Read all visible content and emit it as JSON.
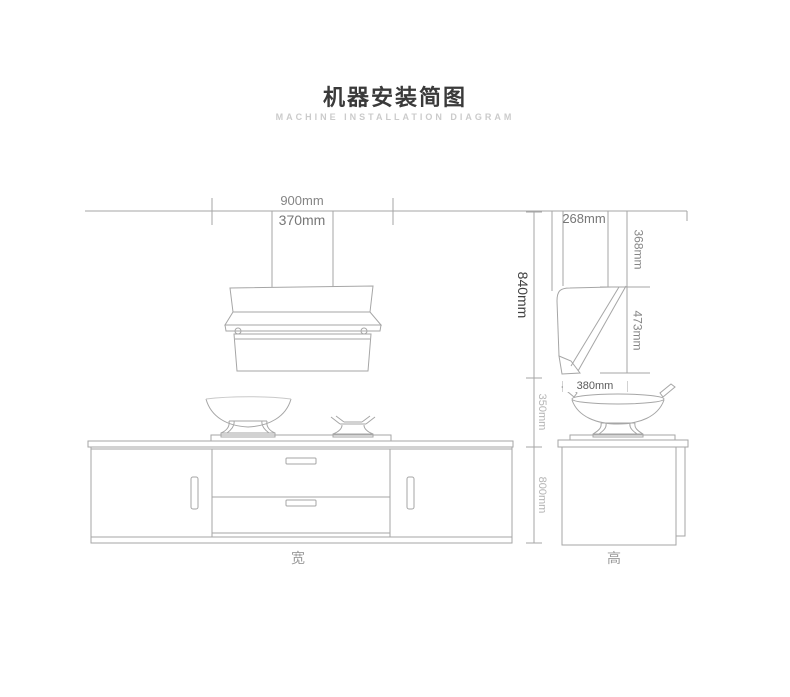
{
  "header": {
    "title": "机器安装简图",
    "subtitle": "MACHINE INSTALLATION DIAGRAM"
  },
  "front_view": {
    "dim_total_width": "900mm",
    "dim_duct_width": "370mm",
    "dim_ceiling_to_hood_bottom": "840mm",
    "dim_hood_to_countertop": "350mm",
    "dim_countertop_height": "800mm",
    "axis_label": "宽"
  },
  "side_view": {
    "dim_top_depth": "268mm",
    "dim_upper_section_height": "368mm",
    "dim_body_height": "473mm",
    "dim_bottom_depth": "380mm",
    "axis_label": "高"
  },
  "colors": {
    "line": "#a6a6a6",
    "line_light": "#bdbdbd",
    "text_dark": "#3f3f3f",
    "text_mid": "#858585",
    "text_light": "#b5b5b5",
    "subtitle": "#cbcbcb"
  }
}
